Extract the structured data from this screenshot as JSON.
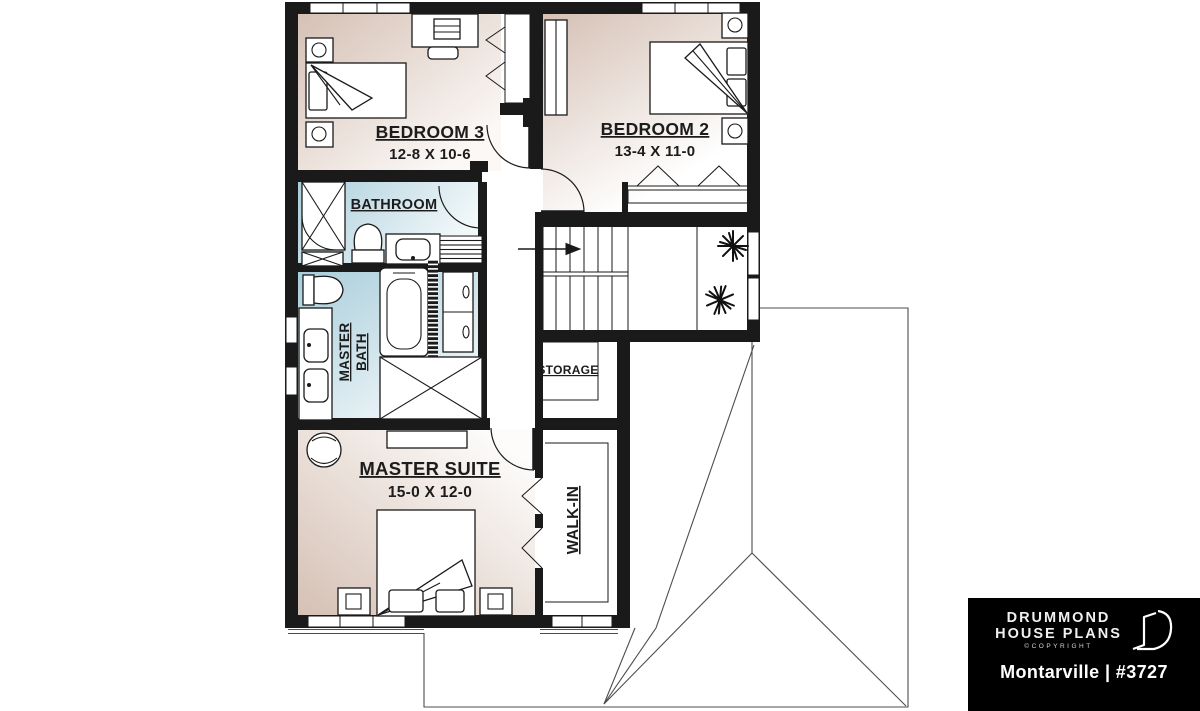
{
  "plan_labels": {
    "bedroom3": {
      "name": "BEDROOM 3",
      "dims": "12-8 X 10-6"
    },
    "bedroom2": {
      "name": "BEDROOM 2",
      "dims": "13-4 X 11-0"
    },
    "bathroom": {
      "name": "BATHROOM"
    },
    "master_bath": {
      "line1": "MASTER",
      "line2": "BATH"
    },
    "master_suite": {
      "name": "MASTER SUITE",
      "dims": "15-0 X 12-0"
    },
    "walk_in": {
      "name": "WALK-IN"
    },
    "storage": {
      "name": "STORAGE"
    }
  },
  "branding": {
    "company_line1": "DRUMMOND",
    "company_line2": "HOUSE PLANS",
    "copyright": "©COPYRIGHT",
    "plan_title": "Montarville | #3727"
  },
  "colors": {
    "wall": "#1a1a1a",
    "bedroom_fill": "#d5c0b4",
    "bath_fill": "#a9cdda",
    "roof_line": "#4d4d4d",
    "logo_bg": "#000000",
    "logo_text": "#ffffff"
  }
}
